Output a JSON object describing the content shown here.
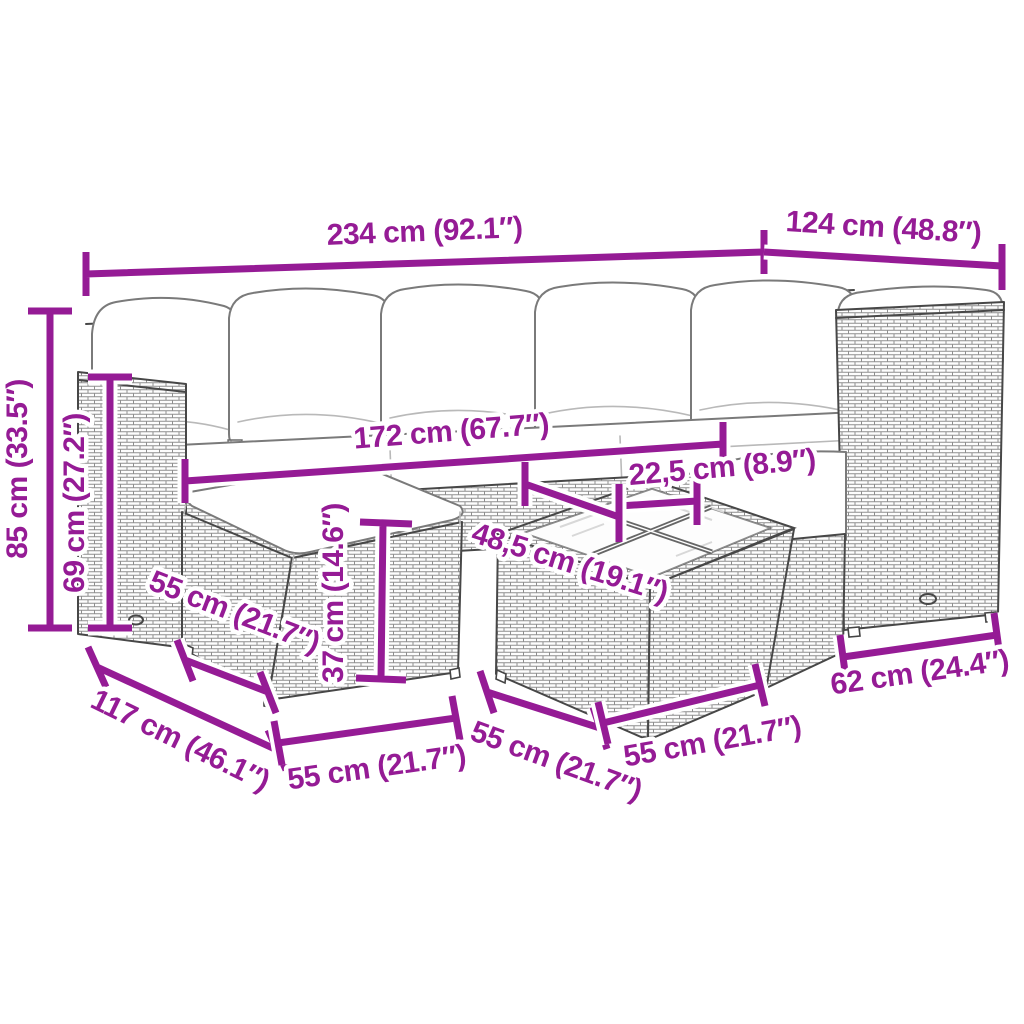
{
  "diagram": {
    "accent_color": "#951B95",
    "outline_color": "#474747",
    "background_color": "#ffffff"
  },
  "dimensions": {
    "total_width": "234 cm (92.1″)",
    "right_depth": "124 cm (48.8″)",
    "total_height": "85 cm (33.5″)",
    "armrest_height": "69 cm (27.2″)",
    "inner_width": "172 cm (67.7″)",
    "glass_pane_width": "22,5 cm (8.9″)",
    "table_top_depth": "48,5 cm (19.1″)",
    "table_height": "37 cm (14.6″)",
    "sofa_depth": "117 cm (46.1″)",
    "stool_side": "55 cm (21.7″)",
    "stool_front": "55 cm (21.7″)",
    "table_side": "55 cm (21.7″)",
    "table_front": "55 cm (21.7″)",
    "right_base_width": "62 cm (24.4″)"
  }
}
